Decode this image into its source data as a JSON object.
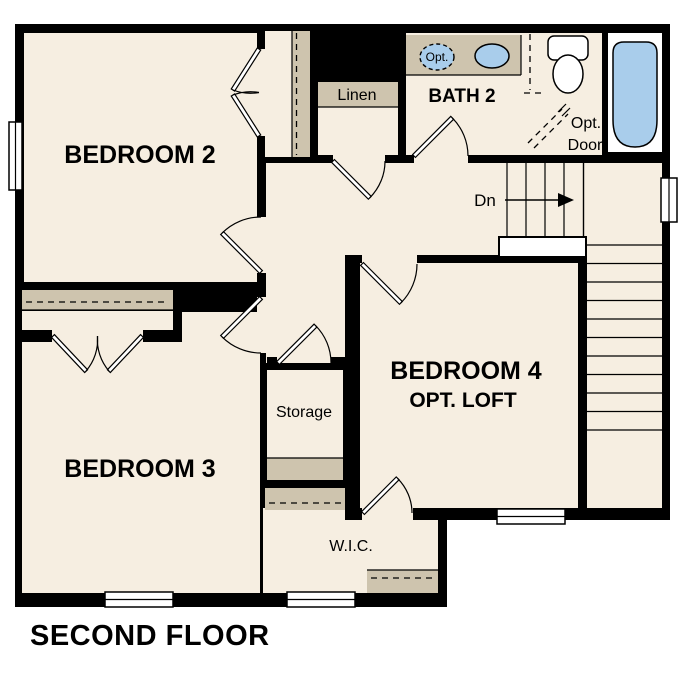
{
  "title": "SECOND FLOOR",
  "rooms": {
    "bedroom2": {
      "label": "BEDROOM 2"
    },
    "bedroom3": {
      "label": "BEDROOM 3"
    },
    "bedroom4": {
      "label": "BEDROOM 4",
      "sublabel": "OPT. LOFT"
    },
    "bath2": {
      "label": "BATH 2"
    },
    "linen": {
      "label": "Linen"
    },
    "storage": {
      "label": "Storage"
    },
    "wic": {
      "label": "W.I.C."
    }
  },
  "stairs": {
    "down_label": "Dn"
  },
  "annotations": {
    "opt_sink": "Opt.",
    "opt_door_line1": "Opt.",
    "opt_door_line2": "Door"
  },
  "colors": {
    "wall": "#000000",
    "floor": "#f6eee1",
    "cabinet": "#cec4ae",
    "fixture_blue": "#a9cdeb",
    "background": "#ffffff"
  }
}
